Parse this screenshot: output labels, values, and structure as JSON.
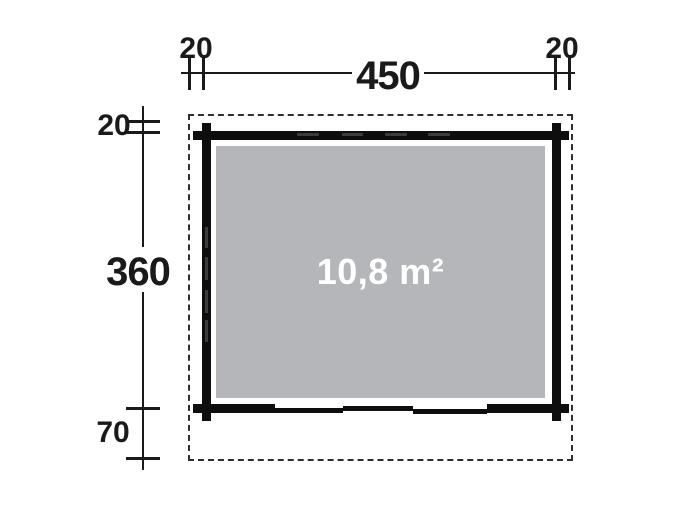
{
  "floor_plan": {
    "labels": {
      "top_left_offset": "20",
      "top_width": "450",
      "top_right_offset": "20",
      "left_top_offset": "20",
      "left_height": "360",
      "left_bottom_offset": "70",
      "area": "10,8 m²"
    },
    "colors": {
      "wall": "#0e0e0e",
      "floor_fill": "#b4b6b9",
      "area_text": "#ffffff",
      "dimension_lines": "#1a1a1a",
      "roof_outline": "#2e2e2e",
      "background": "#ffffff"
    }
  }
}
